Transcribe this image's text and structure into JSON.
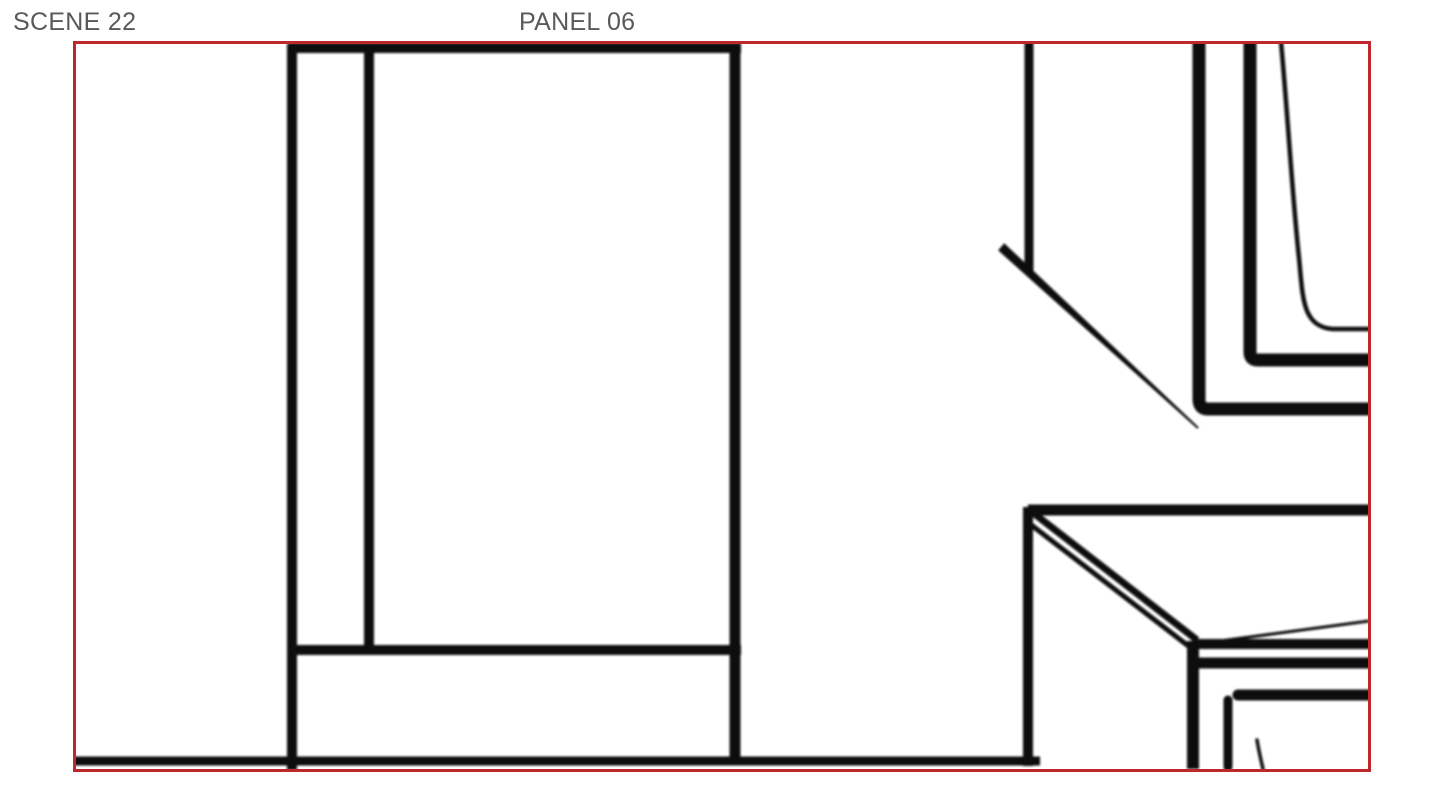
{
  "header": {
    "scene_label": "SCENE 22",
    "panel_label": "PANEL 06"
  },
  "colors": {
    "background": "#ffffff",
    "frame": "#c0272d",
    "ink": "#0b0b0b",
    "label_text": "#59595b"
  },
  "sketch": {
    "blur_px": 1.1,
    "strokes": [
      {
        "name": "door-frame-top",
        "d": "M288,48 L741,48",
        "w": 10
      },
      {
        "name": "door-frame-left",
        "d": "M292,44 L292,770",
        "w": 10
      },
      {
        "name": "door-mullion",
        "d": "M369,50 L369,652",
        "w": 10
      },
      {
        "name": "door-frame-right",
        "d": "M735,44 L735,763",
        "w": 11
      },
      {
        "name": "door-bottom-rail",
        "d": "M289,650 L741,650",
        "w": 10
      },
      {
        "name": "floor-line",
        "d": "M74,761 L1040,761",
        "w": 9
      },
      {
        "name": "wall-corner-vertical",
        "d": "M1029,42 L1029,274",
        "w": 9
      },
      {
        "name": "wall-corner-diagonal",
        "d": "M998.2,250.4 L1004.2,243.2 L1198.7,427.3 L1197.3,428.7 Z",
        "fill": true
      },
      {
        "name": "window-frame-outer",
        "d": "M1199,42 L1199,399 Q1199,409 1208,409 L1372,409",
        "w": 13
      },
      {
        "name": "window-frame-middle",
        "d": "M1250,42 L1250,352 Q1250,360 1258,360 L1372,360",
        "w": 13
      },
      {
        "name": "window-frame-inner-curve",
        "d": "M1281,42 C1288,118 1292,192 1299,258 C1303,298 1302,326 1332,329 L1372,329",
        "w": 4.5
      },
      {
        "name": "table-top-edge",
        "d": "M1028,510 L1372,510",
        "w": 11
      },
      {
        "name": "table-left-leg",
        "d": "M1028,507 L1028,766",
        "w": 10
      },
      {
        "name": "table-edge-upper-diagonal",
        "d": "M1032,512 L1197,640",
        "w": 7
      },
      {
        "name": "table-edge-lower-diagonal",
        "d": "M1030,524 L1191,648",
        "w": 5
      },
      {
        "name": "table-corner-leg",
        "d": "M1193,641 L1193,769",
        "w": 12
      },
      {
        "name": "table-apron-upper",
        "d": "M1195,644 L1372,644",
        "w": 10
      },
      {
        "name": "table-apron-lower",
        "d": "M1189,663 L1372,663",
        "w": 11
      },
      {
        "name": "table-thin-diagonal",
        "d": "M1205,643 L1369,621",
        "w": 3
      },
      {
        "name": "stool-top-edge",
        "d": "M1238,695 L1372,695",
        "w": 11,
        "cap": "round"
      },
      {
        "name": "stool-leg",
        "d": "M1228,700 L1228,767",
        "w": 9,
        "cap": "round"
      },
      {
        "name": "small-accent-stroke",
        "d": "M1257,740 C1259,752 1261,760 1263,769",
        "w": 3.5,
        "cap": "round"
      }
    ]
  }
}
